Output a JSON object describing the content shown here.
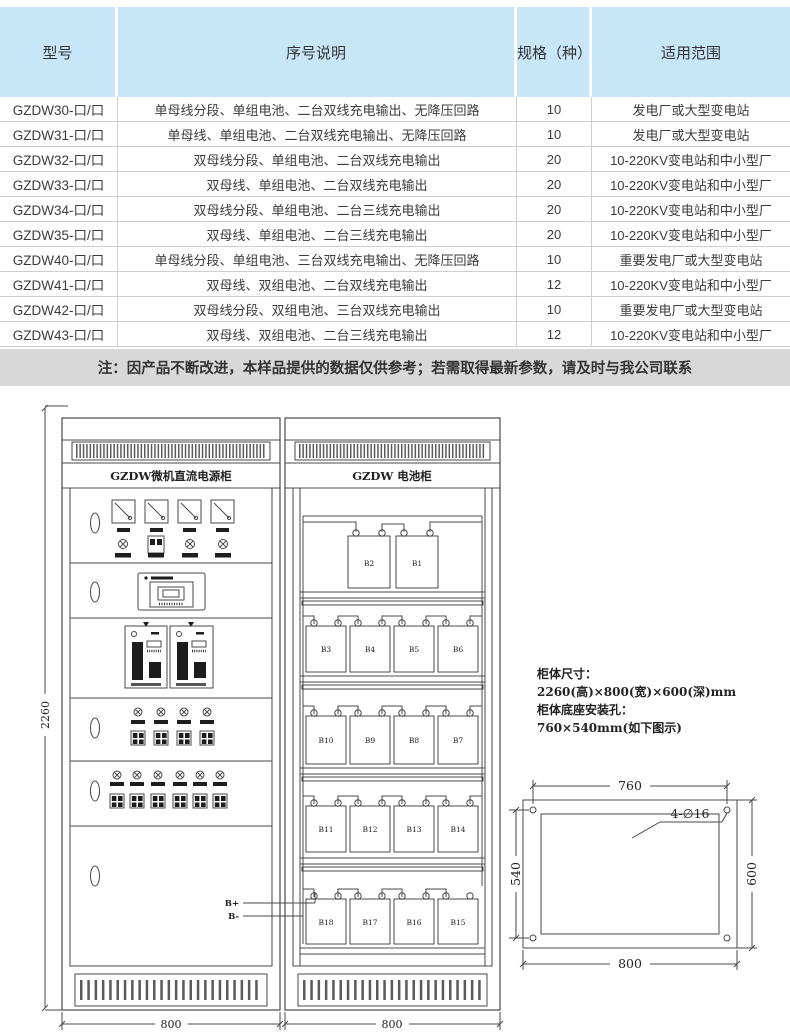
{
  "table": {
    "headers": [
      "型号",
      "序号说明",
      "规格（种）",
      "适用范围"
    ],
    "rows": [
      {
        "model": "GZDW30-口/口",
        "desc": "单母线分段、单组电池、二台双线充电输出、无降压回路",
        "spec": "10",
        "range": "发电厂或大型变电站"
      },
      {
        "model": "GZDW31-口/口",
        "desc": "单母线、单组电池、二台双线充电输出、无降压回路",
        "spec": "10",
        "range": "发电厂或大型变电站"
      },
      {
        "model": "GZDW32-口/口",
        "desc": "双母线分段、单组电池、二台双线充电输出",
        "spec": "20",
        "range": "10-220KV变电站和中小型厂"
      },
      {
        "model": "GZDW33-口/口",
        "desc": "双母线、单组电池、二台双线充电输出",
        "spec": "20",
        "range": "10-220KV变电站和中小型厂"
      },
      {
        "model": "GZDW34-口/口",
        "desc": "双母线分段、单组电池、二台三线充电输出",
        "spec": "20",
        "range": "10-220KV变电站和中小型厂"
      },
      {
        "model": "GZDW35-口/口",
        "desc": "双母线、单组电池、二台三线充电输出",
        "spec": "20",
        "range": "10-220KV变电站和中小型厂"
      },
      {
        "model": "GZDW40-口/口",
        "desc": "单母线分段、单组电池、三台双线充电输出、无降压回路",
        "spec": "10",
        "range": "重要发电厂或大型变电站"
      },
      {
        "model": "GZDW41-口/口",
        "desc": "双母线、双组电池、二台双线充电输出",
        "spec": "12",
        "range": "10-220KV变电站和中小型厂"
      },
      {
        "model": "GZDW42-口/口",
        "desc": "双母线分段、双组电池、三台双线充电输出",
        "spec": "10",
        "range": "重要发电厂或大型变电站"
      },
      {
        "model": "GZDW43-口/口",
        "desc": "双母线、双组电池、二台三线充电输出",
        "spec": "12",
        "range": "10-220KV变电站和中小型厂"
      }
    ]
  },
  "note": {
    "text": "注：因产品不断改进，本样品提供的数据仅供参考；若需取得最新参数，请及时与我公司联系"
  },
  "drawing": {
    "power_title": "GZDW微机直流电源柜",
    "battery_title": "GZDW 电池柜",
    "battery_shelves": [
      [
        "B2",
        "B1"
      ],
      [
        "B3",
        "B4",
        "B5",
        "B6"
      ],
      [
        "B10",
        "B9",
        "B8",
        "B7"
      ],
      [
        "B11",
        "B12",
        "B13",
        "B14"
      ],
      [
        "B18",
        "B17",
        "B16",
        "B15"
      ]
    ],
    "terminals": {
      "pos": "B+",
      "neg": "B-"
    },
    "dims": {
      "cabinet_height": "2260",
      "cabinet_width": "800"
    },
    "specs": [
      "柜体尺寸：",
      "2260(高)×800(宽)×600(深)mm",
      "柜体底座安装孔：",
      "760×540mm(如下图示)"
    ],
    "mounting": {
      "top": "760",
      "bottom": "800",
      "left": "540",
      "right": "600",
      "hole_label": "4-∅16"
    }
  },
  "colors": {
    "header_bg": "#c7e6f8",
    "note_bg": "#d8d8d8",
    "line": "#4a4a4a"
  }
}
